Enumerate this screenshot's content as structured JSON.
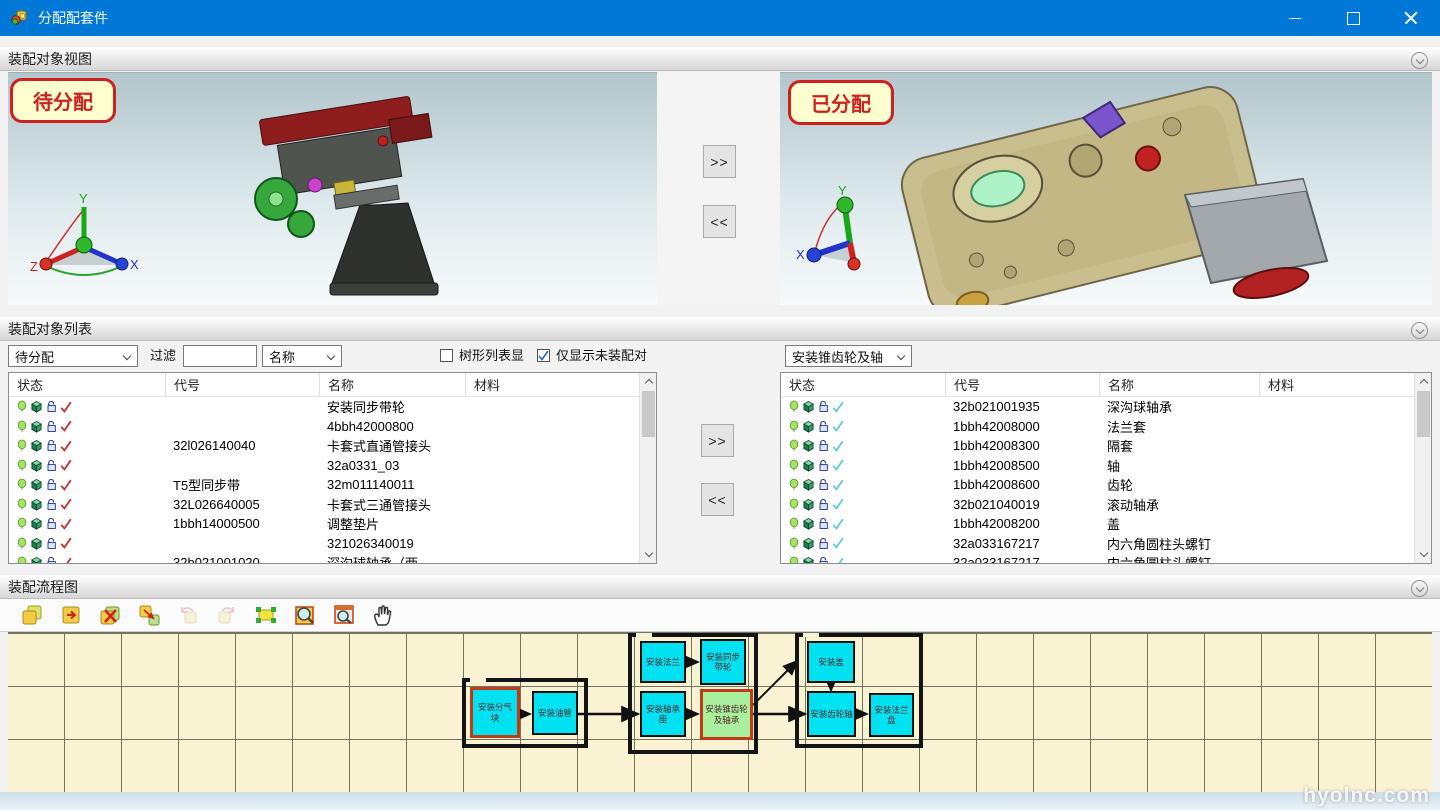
{
  "window": {
    "title": "分配配套件"
  },
  "sections": {
    "viewer_title": "装配对象视图",
    "list_title": "装配对象列表",
    "flow_title": "装配流程图"
  },
  "viewer": {
    "pending_label": "待分配",
    "assigned_label": "已分配",
    "move_right": ">>",
    "move_left": "<<",
    "axis": {
      "x": "X",
      "y": "Y",
      "z": "Z"
    }
  },
  "list_panel": {
    "scope_select": "待分配",
    "filter_label": "过滤",
    "filter_value": "",
    "field_select": "名称",
    "tree_checkbox_label": "树形列表显",
    "tree_checkbox_checked": false,
    "unassembled_checkbox_label": "仅显示未装配对",
    "unassembled_checkbox_checked": true,
    "group_select": "安装锥齿轮及轴",
    "move_right": ">>",
    "move_left": "<<",
    "columns": {
      "status": "状态",
      "code": "代号",
      "name": "名称",
      "material": "材料"
    },
    "left_rows": [
      {
        "code": "",
        "name": "安装同步带轮",
        "material": ""
      },
      {
        "code": "",
        "name": "4bbh42000800",
        "material": ""
      },
      {
        "code": "32l026140040",
        "name": "卡套式直通管接头",
        "material": ""
      },
      {
        "code": "",
        "name": "32a0331_03",
        "material": ""
      },
      {
        "code": "T5型同步带",
        "name": "32m011140011",
        "material": ""
      },
      {
        "code": "32L026640005",
        "name": "卡套式三通管接头",
        "material": ""
      },
      {
        "code": "1bbh14000500",
        "name": "调整垫片",
        "material": ""
      },
      {
        "code": "",
        "name": "321026340019",
        "material": ""
      },
      {
        "code": "32b021001020",
        "name": "深沟球轴承（两...",
        "material": ""
      }
    ],
    "right_rows": [
      {
        "code": "32b021001935",
        "name": "深沟球轴承",
        "material": ""
      },
      {
        "code": "1bbh42008000",
        "name": "法兰套",
        "material": ""
      },
      {
        "code": "1bbh42008300",
        "name": "隔套",
        "material": ""
      },
      {
        "code": "1bbh42008500",
        "name": "轴",
        "material": ""
      },
      {
        "code": "1bbh42008600",
        "name": "齿轮",
        "material": ""
      },
      {
        "code": "32b021040019",
        "name": "滚动轴承",
        "material": ""
      },
      {
        "code": "1bbh42008200",
        "name": "盖",
        "material": ""
      },
      {
        "code": "32a033167217",
        "name": "内六角圆柱头螺钉",
        "material": ""
      },
      {
        "code": "32a033167217",
        "name": "内六角圆柱头螺钉",
        "material": ""
      }
    ]
  },
  "flow": {
    "toolbar_icons": [
      "copy-node-icon",
      "insert-node-icon",
      "delete-node-icon",
      "move-node-icon",
      "undo-icon",
      "redo-icon",
      "fit-view-icon",
      "zoom-region-icon",
      "zoom-window-icon",
      "pan-hand-icon"
    ],
    "nodes": [
      {
        "label": "安装分气块"
      },
      {
        "label": "安装油管"
      },
      {
        "label": "安装法兰"
      },
      {
        "label": "安装同步带轮"
      },
      {
        "label": "安装轴承座"
      },
      {
        "label": "安装锥齿轮及轴承"
      },
      {
        "label": "安装盖"
      },
      {
        "label": "安装齿轮轴"
      },
      {
        "label": "安装法兰盘"
      }
    ],
    "watermark": "hyolnc.com"
  },
  "colors": {
    "titlebar": "#0078d7",
    "canvas_yellow": "#faf3d3",
    "node_cyan": "#00e1f2",
    "node_green": "#a9ef9d",
    "accent_red": "#cf2020"
  }
}
